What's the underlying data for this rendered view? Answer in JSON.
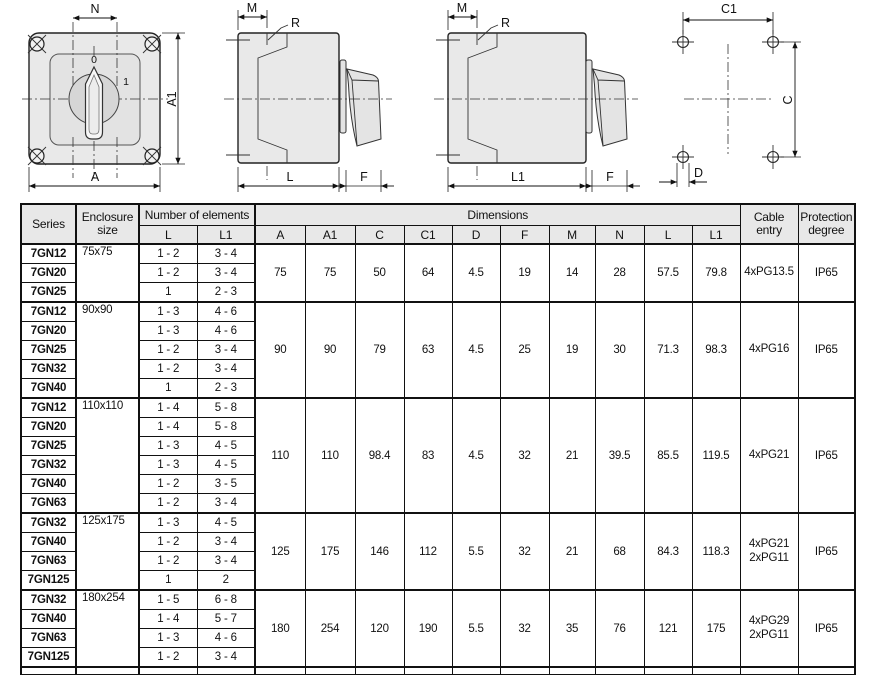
{
  "colors": {
    "line": "#1a1a1a",
    "fill_light": "#e9e9e9",
    "header_bg": "#e8e8e8"
  },
  "drawings": {
    "front": {
      "n": "N",
      "a": "A",
      "a1": "A1",
      "zero": "0",
      "one": "1"
    },
    "side_l": {
      "m": "M",
      "r": "R",
      "l": "L",
      "f": "F"
    },
    "side_l1": {
      "m": "M",
      "r": "R",
      "l1": "L1",
      "f": "F"
    },
    "holes": {
      "c1": "C1",
      "c": "C",
      "d": "D"
    }
  },
  "table": {
    "headers": {
      "series": "Series",
      "enclosure": "Enclosure\nsize",
      "elements": "Number of elements",
      "dimensions": "Dimensions",
      "cable": "Cable\nentry",
      "protection": "Protection\ndegree",
      "sub": [
        "L",
        "L1",
        "A",
        "A1",
        "C",
        "C1",
        "D",
        "F",
        "M",
        "N",
        "L",
        "L1"
      ]
    },
    "groups": [
      {
        "enclosure": "75x75",
        "rows": [
          {
            "series": "7GN12",
            "l": "1 - 2",
            "l1": "3 - 4"
          },
          {
            "series": "7GN20",
            "l": "1 - 2",
            "l1": "3 - 4"
          },
          {
            "series": "7GN25",
            "l": "1",
            "l1": "2 - 3"
          }
        ],
        "dims": [
          "75",
          "75",
          "50",
          "64",
          "4.5",
          "19",
          "14",
          "28",
          "57.5",
          "79.8"
        ],
        "cable": "4xPG13.5",
        "protection": "IP65"
      },
      {
        "enclosure": "90x90",
        "rows": [
          {
            "series": "7GN12",
            "l": "1 - 3",
            "l1": "4 - 6"
          },
          {
            "series": "7GN20",
            "l": "1 - 3",
            "l1": "4 - 6"
          },
          {
            "series": "7GN25",
            "l": "1 - 2",
            "l1": "3 - 4"
          },
          {
            "series": "7GN32",
            "l": "1 - 2",
            "l1": "3 - 4"
          },
          {
            "series": "7GN40",
            "l": "1",
            "l1": "2 - 3"
          }
        ],
        "dims": [
          "90",
          "90",
          "79",
          "63",
          "4.5",
          "25",
          "19",
          "30",
          "71.3",
          "98.3"
        ],
        "cable": "4xPG16",
        "protection": "IP65"
      },
      {
        "enclosure": "110x110",
        "rows": [
          {
            "series": "7GN12",
            "l": "1 - 4",
            "l1": "5 - 8"
          },
          {
            "series": "7GN20",
            "l": "1 - 4",
            "l1": "5 - 8"
          },
          {
            "series": "7GN25",
            "l": "1 - 3",
            "l1": "4 - 5"
          },
          {
            "series": "7GN32",
            "l": "1 - 3",
            "l1": "4 - 5"
          },
          {
            "series": "7GN40",
            "l": "1 - 2",
            "l1": "3 - 5"
          },
          {
            "series": "7GN63",
            "l": "1 - 2",
            "l1": "3 - 4"
          }
        ],
        "dims": [
          "110",
          "110",
          "98.4",
          "83",
          "4.5",
          "32",
          "21",
          "39.5",
          "85.5",
          "119.5"
        ],
        "cable": "4xPG21",
        "protection": "IP65"
      },
      {
        "enclosure": "125x175",
        "rows": [
          {
            "series": "7GN32",
            "l": "1 - 3",
            "l1": "4 - 5"
          },
          {
            "series": "7GN40",
            "l": "1 - 2",
            "l1": "3 - 4"
          },
          {
            "series": "7GN63",
            "l": "1 - 2",
            "l1": "3 - 4"
          },
          {
            "series": "7GN125",
            "l": "1",
            "l1": "2"
          }
        ],
        "dims": [
          "125",
          "175",
          "146",
          "112",
          "5.5",
          "32",
          "21",
          "68",
          "84.3",
          "118.3"
        ],
        "cable": "4xPG21\n2xPG11",
        "protection": "IP65"
      },
      {
        "enclosure": "180x254",
        "rows": [
          {
            "series": "7GN32",
            "l": "1 - 5",
            "l1": "6 - 8"
          },
          {
            "series": "7GN40",
            "l": "1 - 4",
            "l1": "5 - 7"
          },
          {
            "series": "7GN63",
            "l": "1 - 3",
            "l1": "4 - 6"
          },
          {
            "series": "7GN125",
            "l": "1 - 2",
            "l1": "3 - 4"
          }
        ],
        "dims": [
          "180",
          "254",
          "120",
          "190",
          "5.5",
          "32",
          "35",
          "76",
          "121",
          "175"
        ],
        "cable": "4xPG29\n2xPG11",
        "protection": "IP65"
      }
    ]
  }
}
